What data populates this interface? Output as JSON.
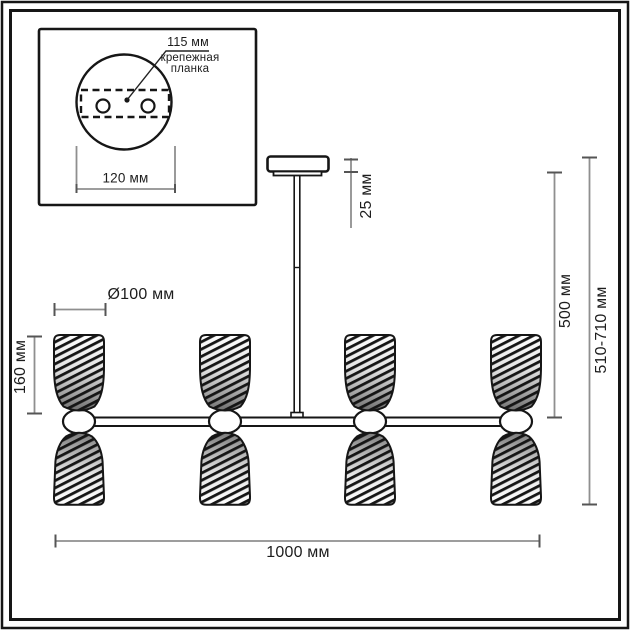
{
  "inset": {
    "hole_spacing": "115 мм",
    "mount_plate_line1": "крепежная",
    "mount_plate_line2": "планка",
    "canopy_diameter": "120 мм"
  },
  "dimensions": {
    "canopy_height": "25 мм",
    "stem_length": "500 мм",
    "overall_height": "510-710 мм",
    "shade_diameter": "Ø100 мм",
    "shade_height": "160 мм",
    "overall_width": "1000 мм"
  },
  "colors": {
    "line": "#161616",
    "dim_line": "#8f8f8f",
    "tick": "#555555",
    "text": "#1d1d1d",
    "background": "#ffffff"
  }
}
